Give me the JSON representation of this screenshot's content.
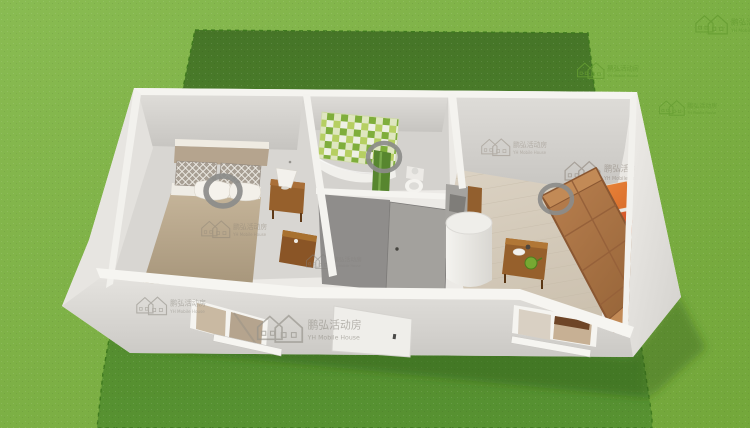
{
  "scene": {
    "type": "3d-floorplan-render",
    "rooms": [
      "bedroom",
      "bathroom",
      "living-room"
    ]
  },
  "watermark": {
    "brand_cn": "鹏弘活动房",
    "brand_en": "YH Mobile House"
  },
  "colors": {
    "grass": "#7cb43f",
    "plot": "#579231",
    "plot_border": "#3f7a1e",
    "shadow_green": "#2e5a17",
    "wall_white": "#f5f4f0",
    "wall_face": "#e4e2de",
    "interior_wall": "#dedcd8",
    "bedroom_floor": "#d8d6d2",
    "wood_floor": "#dbd2c3",
    "gray_wall": "#8f8d8b",
    "gray_door": "#a3a19d",
    "tile_green": "#7fae3b",
    "tile_lime": "#b6cf62",
    "sofa_brown": "#bb8150",
    "painting_orange": "#d96b2a",
    "painting_red_orange": "#cc4a24",
    "painting_red": "#ab241e",
    "blanket_tan": "#c5b499",
    "pillow_gray": "#a89f94",
    "curtain_tan": "#c9b9a2",
    "furniture_wood": "#96602c",
    "heater_white": "#f4f3ef",
    "ring_gray": "#8c8c8a",
    "watermark_gray": "#95928a",
    "watermark_green": "#679e33"
  }
}
